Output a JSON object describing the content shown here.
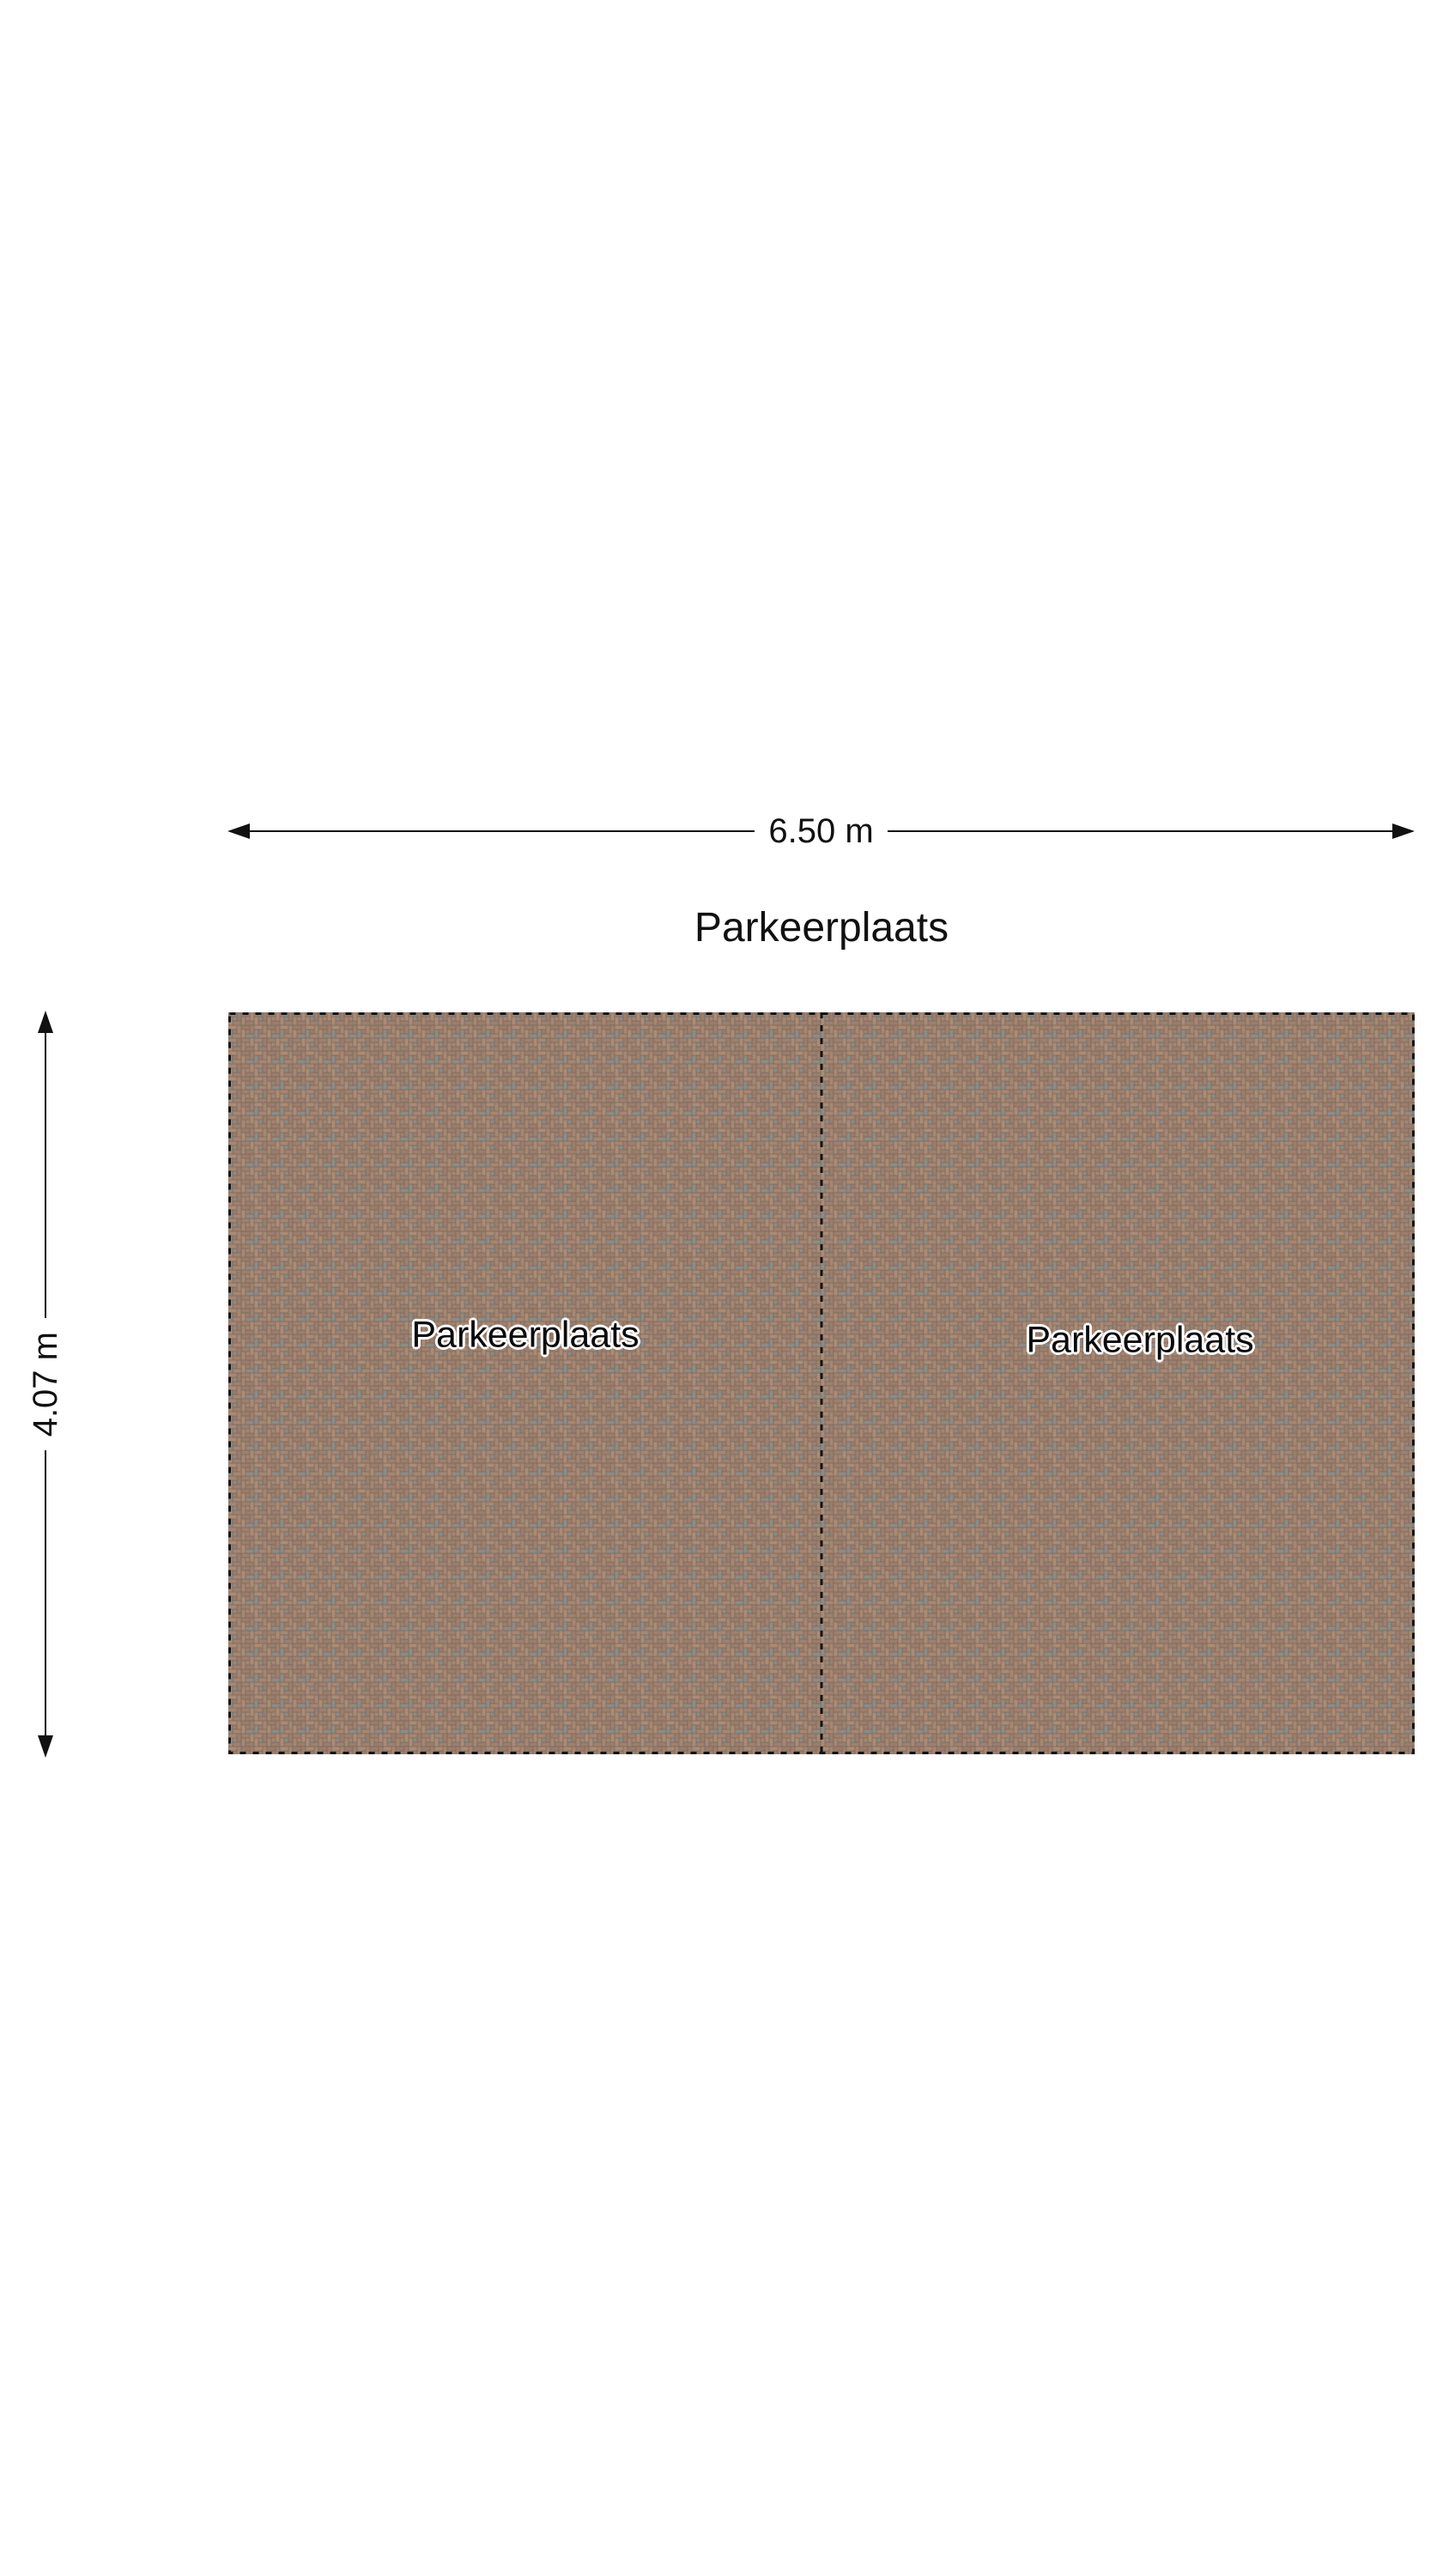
{
  "title": "Parkeerplaats",
  "dimension_width": {
    "label": "6.50 m"
  },
  "dimension_height": {
    "label": "4.07 m"
  },
  "parking_area": {
    "spots": [
      {
        "label": "Parkeerplaats"
      },
      {
        "label": "Parkeerplaats"
      }
    ]
  },
  "colors": {
    "background": "#ffffff",
    "text": "#111111",
    "line": "#111111",
    "grout": "#72665c",
    "brick_a": "#a68672",
    "brick_b": "#9b7d6b",
    "brick_c": "#ab8b75",
    "brick_d": "#9f806d",
    "brick_gray": "#8e8a84"
  }
}
